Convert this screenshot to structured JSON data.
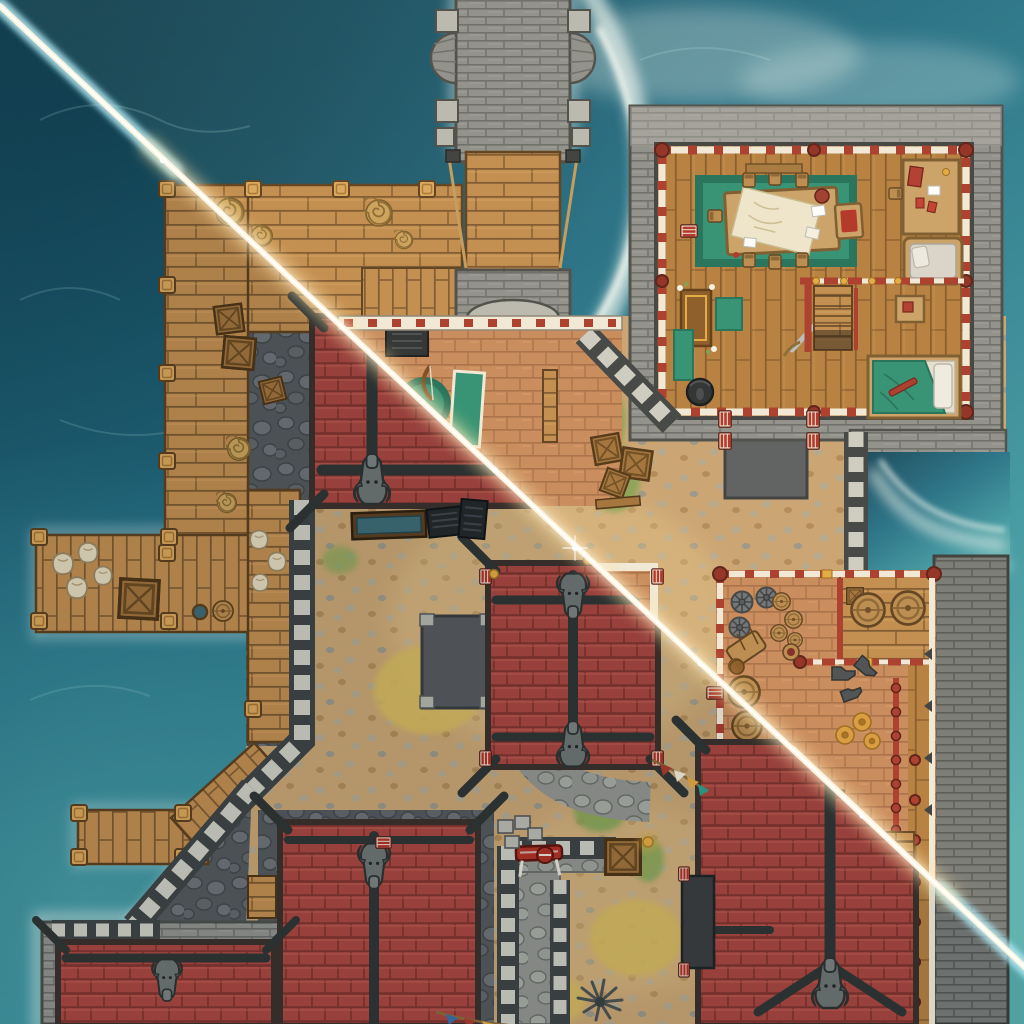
{
  "canvas": {
    "width": 1024,
    "height": 1024
  },
  "palette": {
    "water_deep": "#15485c",
    "water_mid": "#247189",
    "water_shallow": "#3e98a4",
    "water_bright": "#5ab0b2",
    "foam_white": "#eef7f3",
    "beam_core": "#fff6dd",
    "beam_warm": "#ffe2a6",
    "beam_cyan": "#9fe4f0",
    "roof_red": "#a84540",
    "roof_red_dark": "#7e312e",
    "roof_red_light": "#c05a50",
    "ridge_dark": "#2f3433",
    "gargoyle_grey": "#6d7472",
    "stone_light": "#b9b9b2",
    "stone_mid": "#8f908c",
    "stone_dark": "#5d605f",
    "stone_outline": "#3f4241",
    "merlon_light": "#cdccc3",
    "cobble_dark": "#53575b",
    "cobble_stone": "#6c7176",
    "path_grey": "#92948f",
    "path_stone": "#a9aba4",
    "dirt_tan": "#c9a473",
    "dirt_stone": "#b5a78e",
    "grass_green": "#7aa351",
    "grass_dry": "#d6b85c",
    "wood_dock": "#c18d50",
    "wood_dock_dark": "#7d5830",
    "wood_floor": "#b57e40",
    "wood_floor_dark": "#86592a",
    "wood_dark": "#6b4a28",
    "terracotta": "#c8895c",
    "terracotta_dark": "#a76f48",
    "timber_red": "#a93a2d",
    "timber_red_dark": "#7c2318",
    "timber_white": "#f1eadb",
    "rug_green": "#2e9173",
    "rug_green_dark": "#20705a",
    "teal_accent": "#2da08d",
    "gold_accent": "#e2aa42",
    "paper_cream": "#efe6cf",
    "iron_dark": "#2a2e31",
    "rope_tan": "#c39a58"
  },
  "scene": {
    "type": "top-down fantasy battle map",
    "setting": "seaside fortress with docks",
    "lighting": {
      "sunbeam_from": "top-left corner",
      "sunbeam_to": "bottom-right corner",
      "beam_over_water": "cyan",
      "beam_over_land": "warm white",
      "split": "lower-left of beam shows shaded rooftops, upper-right shows lit interiors"
    },
    "water": {
      "label": "teal ocean with breaking foam along walls, docks and bridge"
    },
    "structures": [
      {
        "id": "stone-bridge",
        "label": "stone causeway with twin balconies and rope-hung wooden drawbridge",
        "position": "top-center"
      },
      {
        "id": "gatehouse",
        "label": "gatehouse with iron portcullis",
        "position": "top-center"
      },
      {
        "id": "upper-dock",
        "label": "wooden dock with rope coils and crates",
        "position": "left"
      },
      {
        "id": "lower-dock",
        "label": "L-shaped pier with sacks, crate, barrel and bucket",
        "position": "left-middle"
      },
      {
        "id": "small-dock",
        "label": "small plank dock with mooring posts and angled walkway",
        "position": "bottom-left"
      },
      {
        "id": "map-room",
        "label": "timber-framed hall: map table with chairs on green rug, writing desk, daybed, shrine, bed, cauldron, stairs",
        "position": "top-right"
      },
      {
        "id": "storage-room",
        "label": "storeroom: cart wheels, barrels, kegs, anvils, clay pots, sack, crate, stairs",
        "position": "right-middle"
      },
      {
        "id": "training-room",
        "label": "room with round green rug, green mat and bow",
        "position": "center-left"
      },
      {
        "id": "roof-a",
        "label": "red-tiled hip roof with dragon gargoyle",
        "position": "center-left"
      },
      {
        "id": "roof-b",
        "label": "red-tiled roof with two dragon gargoyles and teal pennant",
        "position": "center"
      },
      {
        "id": "roof-c",
        "label": "red-tiled roof with dragon gargoyle",
        "position": "bottom-center-left"
      },
      {
        "id": "roof-d",
        "label": "red-tiled roof with dragon gargoyle",
        "position": "bottom-left-corner"
      },
      {
        "id": "roof-e",
        "label": "large red-tiled roof with dragon gargoyle and side stairs",
        "position": "bottom-right"
      },
      {
        "id": "courtyard",
        "label": "dirt courtyard with cobblestone paths, grass patches and crate pile"
      },
      {
        "id": "walls",
        "label": "crenellated grey stone walls and outer seawall"
      },
      {
        "id": "sea-inlet",
        "label": "walled sea inlet",
        "position": "right"
      }
    ],
    "props": [
      "rope-coil",
      "crate",
      "sack",
      "barrel",
      "cart-wheel",
      "anvil",
      "clay-pot",
      "water-trough",
      "bench",
      "red-table",
      "stool",
      "bunting-flags",
      "prayer-mat",
      "sword",
      "bow",
      "cauldron",
      "lantern",
      "dock-post",
      "striped-door-marker",
      "spiky-plant",
      "stairs"
    ]
  }
}
